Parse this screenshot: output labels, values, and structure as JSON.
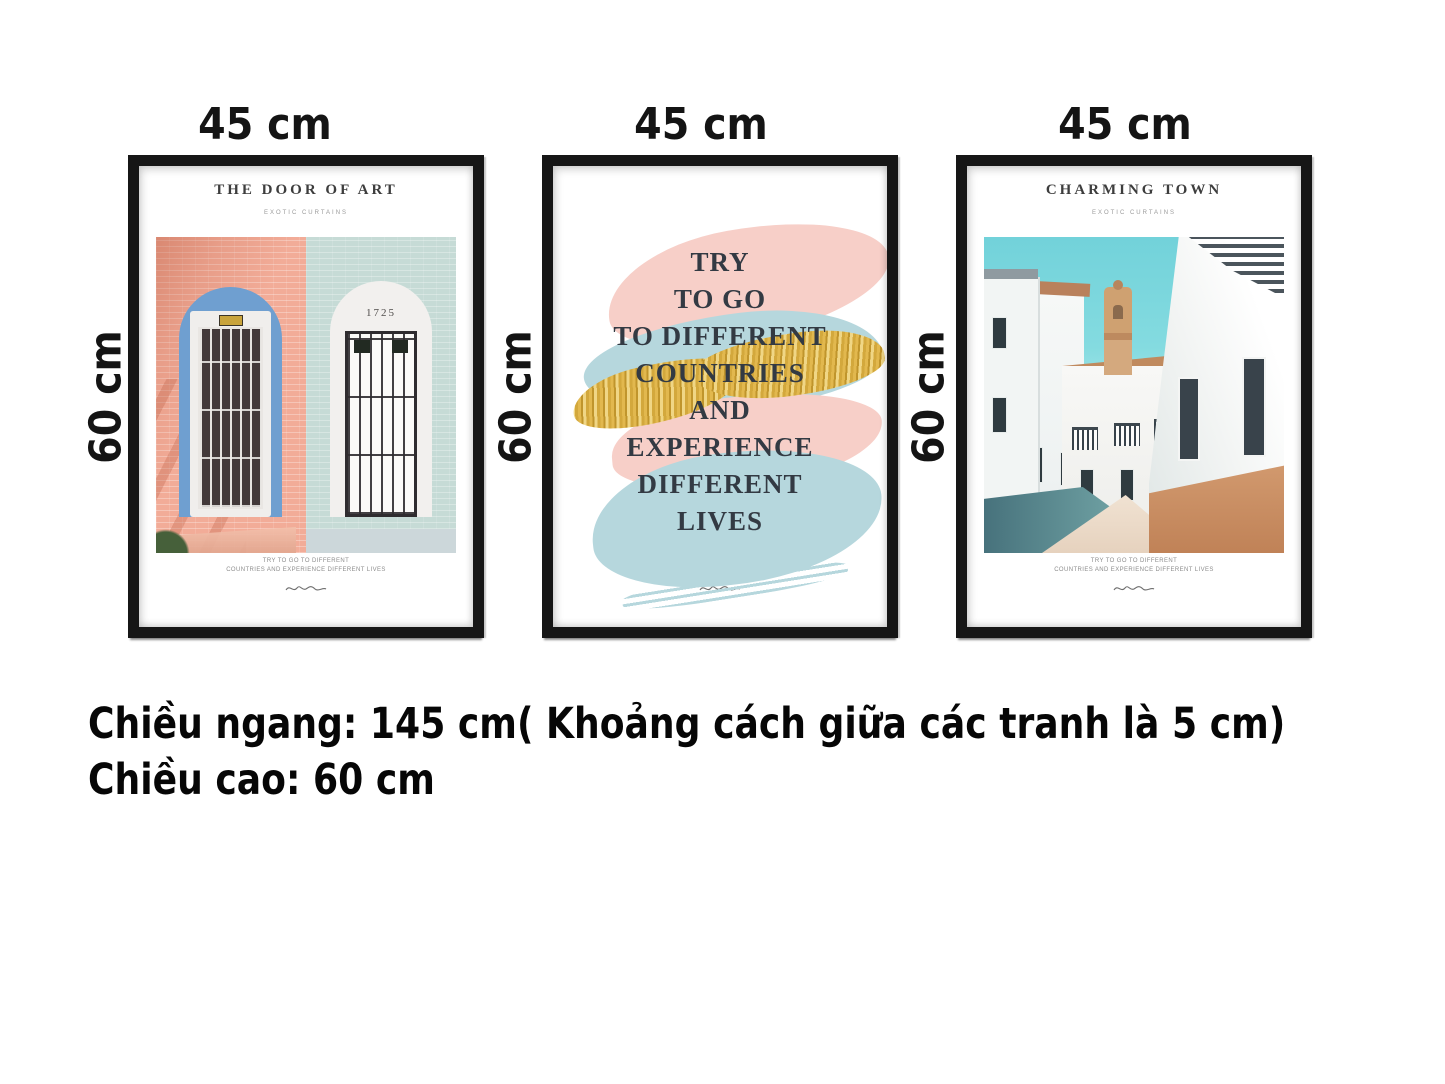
{
  "dimension_labels": {
    "widths": [
      "45 cm",
      "45 cm",
      "45 cm"
    ],
    "heights": [
      "60 cm",
      "60 cm",
      "60 cm"
    ]
  },
  "summary": {
    "line1": "Chiều ngang: 145 cm( Khoảng cách giữa các tranh là 5 cm)",
    "line2": "Chiều cao: 60 cm"
  },
  "set_dimensions": {
    "frame_width_cm": 45,
    "frame_height_cm": 60,
    "gap_cm": 5,
    "total_width_cm": 145,
    "frame_count": 3
  },
  "posters": [
    {
      "name": "door-of-art",
      "title": "THE DOOR OF ART",
      "subtitle": "EXOTIC CURTAINS",
      "door_number": "1725",
      "caption_line1": "TRY TO GO TO DIFFERENT",
      "caption_line2": "COUNTRIES AND EXPERIENCE DIFFERENT LIVES"
    },
    {
      "name": "travel-quote",
      "quote_lines": [
        "TRY",
        "TO GO",
        "TO DIFFERENT",
        "COUNTRIES",
        "AND",
        "EXPERIENCE",
        "DIFFERENT",
        "LIVES"
      ]
    },
    {
      "name": "charming-town",
      "title": "CHARMING TOWN",
      "subtitle": "EXOTIC CURTAINS",
      "caption_line1": "TRY TO GO TO DIFFERENT",
      "caption_line2": "COUNTRIES AND EXPERIENCE DIFFERENT LIVES"
    }
  ],
  "colors": {
    "frame": "#161616",
    "pink_wall": "#f2ac98",
    "mint_wall": "#c6dbd6",
    "arch_blue": "#6f9fd0",
    "stroke_pink": "#f7cfc8",
    "stroke_blue": "#b6d7dd",
    "stroke_gold": "#d9a93f",
    "quote_text": "#333a43",
    "sky_teal": "#72d2da",
    "terracotta": "#c98a61"
  }
}
